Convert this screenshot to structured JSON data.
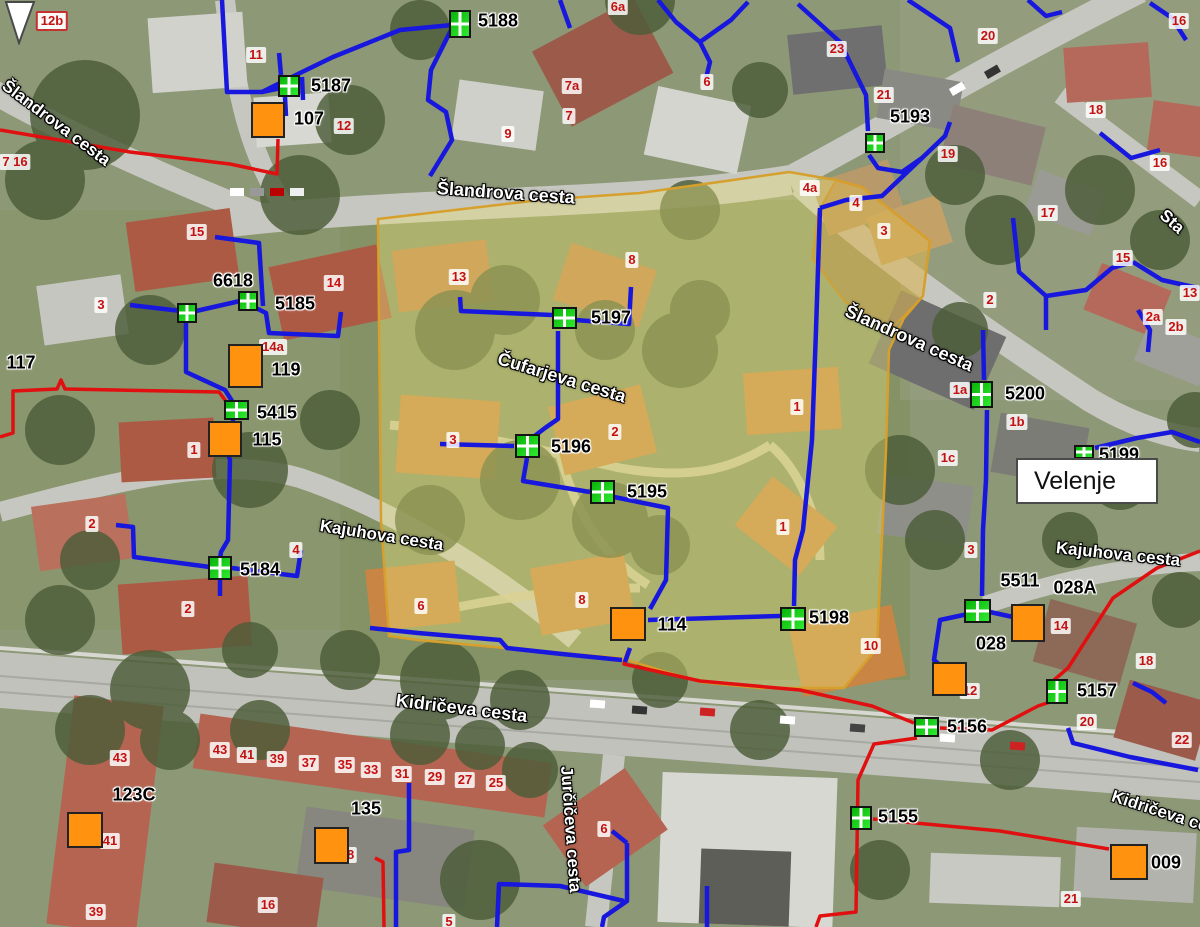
{
  "map": {
    "region_label": "Velenje",
    "streets": [
      {
        "name": "Šlandrova cesta",
        "x": 4,
        "y": 74,
        "rot": 37,
        "size": 17
      },
      {
        "name": "Šlandrova cesta",
        "x": 437,
        "y": 178,
        "rot": 4,
        "size": 18
      },
      {
        "name": "Šlandrova cesta",
        "x": 846,
        "y": 300,
        "rot": 24,
        "size": 18
      },
      {
        "name": "Čufarjeva cesta",
        "x": 498,
        "y": 348,
        "rot": 17,
        "size": 18
      },
      {
        "name": "Kajuhova cesta",
        "x": 320,
        "y": 516,
        "rot": 9,
        "size": 17
      },
      {
        "name": "Kajuhova cesta",
        "x": 1056,
        "y": 538,
        "rot": 6,
        "size": 17
      },
      {
        "name": "Kidričeva cesta",
        "x": 396,
        "y": 690,
        "rot": 7,
        "size": 18
      },
      {
        "name": "Jurčičeva cesta",
        "x": 566,
        "y": 756,
        "rot": 86,
        "size": 17
      },
      {
        "name": "Kidričeva cesta",
        "x": 1112,
        "y": 786,
        "rot": 18,
        "size": 17
      },
      {
        "name": "Sta",
        "x": 1162,
        "y": 203,
        "rot": 42,
        "size": 17
      }
    ],
    "house_numbers": [
      {
        "n": "12b",
        "x": 52,
        "y": 21,
        "bordered": true
      },
      {
        "n": "11",
        "x": 256,
        "y": 55
      },
      {
        "n": "12",
        "x": 344,
        "y": 126
      },
      {
        "n": "9",
        "x": 508,
        "y": 134
      },
      {
        "n": "7a",
        "x": 572,
        "y": 86
      },
      {
        "n": "7",
        "x": 569,
        "y": 116
      },
      {
        "n": "6a",
        "x": 618,
        "y": 7
      },
      {
        "n": "6",
        "x": 707,
        "y": 82
      },
      {
        "n": "23",
        "x": 837,
        "y": 49
      },
      {
        "n": "20",
        "x": 988,
        "y": 36
      },
      {
        "n": "21",
        "x": 884,
        "y": 95
      },
      {
        "n": "19",
        "x": 948,
        "y": 154
      },
      {
        "n": "18",
        "x": 1096,
        "y": 110
      },
      {
        "n": "16",
        "x": 1179,
        "y": 21
      },
      {
        "n": "16",
        "x": 1160,
        "y": 163
      },
      {
        "n": "4a",
        "x": 810,
        "y": 188
      },
      {
        "n": "4",
        "x": 856,
        "y": 203
      },
      {
        "n": "3",
        "x": 884,
        "y": 231
      },
      {
        "n": "17",
        "x": 1048,
        "y": 213
      },
      {
        "n": "15",
        "x": 1123,
        "y": 258
      },
      {
        "n": "13",
        "x": 1190,
        "y": 293
      },
      {
        "n": "2",
        "x": 990,
        "y": 300
      },
      {
        "n": "2a",
        "x": 1153,
        "y": 317
      },
      {
        "n": "2b",
        "x": 1176,
        "y": 327
      },
      {
        "n": "1a",
        "x": 960,
        "y": 390
      },
      {
        "n": "1b",
        "x": 1017,
        "y": 422
      },
      {
        "n": "1c",
        "x": 948,
        "y": 458
      },
      {
        "n": "15",
        "x": 197,
        "y": 232
      },
      {
        "n": "3",
        "x": 101,
        "y": 305
      },
      {
        "n": "14",
        "x": 334,
        "y": 283
      },
      {
        "n": "14a",
        "x": 273,
        "y": 347
      },
      {
        "n": "13",
        "x": 459,
        "y": 277
      },
      {
        "n": "8",
        "x": 632,
        "y": 260
      },
      {
        "n": "2",
        "x": 615,
        "y": 432
      },
      {
        "n": "3",
        "x": 453,
        "y": 440
      },
      {
        "n": "1",
        "x": 797,
        "y": 407
      },
      {
        "n": "1",
        "x": 783,
        "y": 527
      },
      {
        "n": "8",
        "x": 582,
        "y": 600
      },
      {
        "n": "6",
        "x": 421,
        "y": 606
      },
      {
        "n": "10",
        "x": 871,
        "y": 646
      },
      {
        "n": "2",
        "x": 92,
        "y": 524
      },
      {
        "n": "4",
        "x": 296,
        "y": 550
      },
      {
        "n": "2",
        "x": 188,
        "y": 609
      },
      {
        "n": "1",
        "x": 194,
        "y": 450
      },
      {
        "n": "3",
        "x": 971,
        "y": 550
      },
      {
        "n": "14",
        "x": 1061,
        "y": 626
      },
      {
        "n": "12",
        "x": 970,
        "y": 691
      },
      {
        "n": "18",
        "x": 1146,
        "y": 661
      },
      {
        "n": "20",
        "x": 1087,
        "y": 722
      },
      {
        "n": "22",
        "x": 1182,
        "y": 740
      },
      {
        "n": "43",
        "x": 120,
        "y": 758
      },
      {
        "n": "41",
        "x": 110,
        "y": 841
      },
      {
        "n": "39",
        "x": 96,
        "y": 912
      },
      {
        "n": "43",
        "x": 220,
        "y": 750
      },
      {
        "n": "41",
        "x": 247,
        "y": 755
      },
      {
        "n": "39",
        "x": 277,
        "y": 759
      },
      {
        "n": "37",
        "x": 309,
        "y": 763
      },
      {
        "n": "35",
        "x": 345,
        "y": 765
      },
      {
        "n": "33",
        "x": 371,
        "y": 770
      },
      {
        "n": "31",
        "x": 402,
        "y": 774
      },
      {
        "n": "29",
        "x": 435,
        "y": 777
      },
      {
        "n": "27",
        "x": 465,
        "y": 780
      },
      {
        "n": "25",
        "x": 496,
        "y": 783
      },
      {
        "n": "16",
        "x": 268,
        "y": 905
      },
      {
        "n": "6",
        "x": 604,
        "y": 829
      },
      {
        "n": "5",
        "x": 449,
        "y": 922
      },
      {
        "n": "21",
        "x": 1071,
        "y": 899
      },
      {
        "n": "7 16",
        "x": 15,
        "y": 162
      },
      {
        "n": "18",
        "x": 347,
        "y": 855
      }
    ],
    "station_ids": [
      {
        "t": "5188",
        "x": 498,
        "y": 21
      },
      {
        "t": "5187",
        "x": 331,
        "y": 86
      },
      {
        "t": "107",
        "x": 309,
        "y": 119
      },
      {
        "t": "6618",
        "x": 233,
        "y": 281
      },
      {
        "t": "5185",
        "x": 295,
        "y": 304
      },
      {
        "t": "117",
        "x": 21,
        "y": 363
      },
      {
        "t": "119",
        "x": 286,
        "y": 370
      },
      {
        "t": "5415",
        "x": 277,
        "y": 413
      },
      {
        "t": "115",
        "x": 267,
        "y": 440
      },
      {
        "t": "5184",
        "x": 260,
        "y": 570
      },
      {
        "t": "5197",
        "x": 611,
        "y": 318
      },
      {
        "t": "5196",
        "x": 571,
        "y": 447
      },
      {
        "t": "5195",
        "x": 647,
        "y": 492
      },
      {
        "t": "5198",
        "x": 829,
        "y": 618
      },
      {
        "t": "114",
        "x": 672,
        "y": 625
      },
      {
        "t": "5193",
        "x": 910,
        "y": 117
      },
      {
        "t": "5200",
        "x": 1025,
        "y": 394
      },
      {
        "t": "5199",
        "x": 1119,
        "y": 455
      },
      {
        "t": "5511",
        "x": 1020,
        "y": 581
      },
      {
        "t": "028A",
        "x": 1075,
        "y": 588
      },
      {
        "t": "028",
        "x": 991,
        "y": 644
      },
      {
        "t": "5157",
        "x": 1097,
        "y": 691
      },
      {
        "t": "5156",
        "x": 967,
        "y": 727
      },
      {
        "t": "5155",
        "x": 898,
        "y": 817
      },
      {
        "t": "009",
        "x": 1166,
        "y": 863
      },
      {
        "t": "123C",
        "x": 134,
        "y": 795
      },
      {
        "t": "135",
        "x": 366,
        "y": 809
      }
    ],
    "green_markers": [
      {
        "id": "5188",
        "x": 460,
        "y": 24,
        "w": 22,
        "h": 28
      },
      {
        "id": "5187",
        "x": 289,
        "y": 86,
        "w": 22,
        "h": 22
      },
      {
        "id": "6618",
        "x": 187,
        "y": 313,
        "w": 20,
        "h": 20
      },
      {
        "id": "5185",
        "x": 248,
        "y": 301,
        "w": 20,
        "h": 20
      },
      {
        "id": "5415",
        "x": 236,
        "y": 410,
        "w": 25,
        "h": 20
      },
      {
        "id": "5184",
        "x": 220,
        "y": 568,
        "w": 24,
        "h": 24
      },
      {
        "id": "5197",
        "x": 564,
        "y": 318,
        "w": 25,
        "h": 22
      },
      {
        "id": "5196",
        "x": 527,
        "y": 446,
        "w": 25,
        "h": 24
      },
      {
        "id": "5195",
        "x": 602,
        "y": 492,
        "w": 25,
        "h": 24
      },
      {
        "id": "5198",
        "x": 793,
        "y": 619,
        "w": 26,
        "h": 24
      },
      {
        "id": "5193",
        "x": 875,
        "y": 143,
        "w": 20,
        "h": 20
      },
      {
        "id": "5200",
        "x": 981,
        "y": 394,
        "w": 23,
        "h": 27
      },
      {
        "id": "5199",
        "x": 1084,
        "y": 452,
        "w": 20,
        "h": 14
      },
      {
        "id": "5511",
        "x": 977,
        "y": 611,
        "w": 27,
        "h": 24
      },
      {
        "id": "5157",
        "x": 1057,
        "y": 691,
        "w": 22,
        "h": 25
      },
      {
        "id": "5156",
        "x": 926,
        "y": 727,
        "w": 25,
        "h": 20
      },
      {
        "id": "5155",
        "x": 861,
        "y": 818,
        "w": 22,
        "h": 24
      }
    ],
    "orange_markers": [
      {
        "id": "107",
        "x": 268,
        "y": 120,
        "w": 34,
        "h": 36
      },
      {
        "id": "119",
        "x": 245,
        "y": 366,
        "w": 35,
        "h": 44
      },
      {
        "id": "115",
        "x": 225,
        "y": 439,
        "w": 34,
        "h": 36
      },
      {
        "id": "114",
        "x": 628,
        "y": 624,
        "w": 36,
        "h": 34
      },
      {
        "id": "123c",
        "x": 85,
        "y": 830,
        "w": 36,
        "h": 36
      },
      {
        "id": "135",
        "x": 331,
        "y": 845,
        "w": 35,
        "h": 37
      },
      {
        "id": "028",
        "x": 949,
        "y": 679,
        "w": 35,
        "h": 34
      },
      {
        "id": "028a",
        "x": 1028,
        "y": 623,
        "w": 34,
        "h": 38
      },
      {
        "id": "009",
        "x": 1129,
        "y": 862,
        "w": 38,
        "h": 36
      }
    ],
    "colors": {
      "water_line_blue": "#1717dd",
      "heat_line_red": "#e01010",
      "parcel_highlight": "#d79f2b",
      "hydrant_green": "#22dd22",
      "station_orange": "#ff920e",
      "house_number_red": "#c31111"
    }
  }
}
